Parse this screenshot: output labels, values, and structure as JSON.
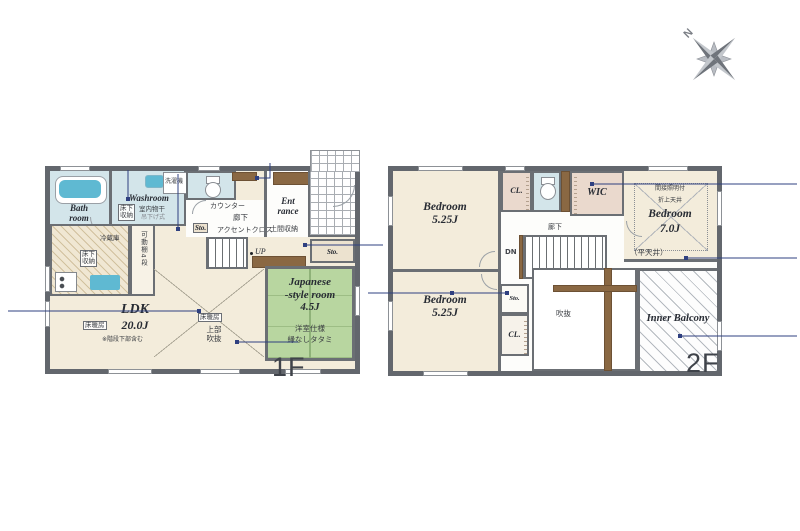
{
  "compass": {
    "north": "N"
  },
  "floor1": {
    "label": "1F",
    "bath": {
      "line1": "Bath",
      "line2": "room"
    },
    "washroom": {
      "name": "Washroom",
      "underfloor_l1": "床下",
      "underfloor_l2": "収納",
      "drying": "室内物干",
      "drying_sub": "吊下げ式",
      "laundry": "洗濯機"
    },
    "hall": {
      "counter": "カウンター",
      "corridor": "廊下",
      "storage": "Sto.",
      "accent_wall": "アクセントクロス",
      "up": "UP"
    },
    "entrance": {
      "line1": "Ent",
      "line2": "rance",
      "doma_storage": "土間収納",
      "storage": "Sto."
    },
    "kitchen": {
      "fridge": "冷蔵庫",
      "underfloor_l1": "床下",
      "underfloor_l2": "収納",
      "shelf": "可動棚4段"
    },
    "ldk": {
      "floor_heating": "床暖房",
      "name": "LDK",
      "size": "20.0J",
      "note": "※階段下部含む"
    },
    "void_above": {
      "floor_heating": "床暖房",
      "line1": "上部",
      "line2": "吹抜"
    },
    "japanese_room": {
      "line1": "Japanese",
      "line2": "-style room",
      "line3": "4.5J",
      "note1": "洋室仕様",
      "note2": "縁なしタタミ"
    }
  },
  "floor2": {
    "label": "2F",
    "bedroom_nw": {
      "name": "Bedroom",
      "size": "5.25J"
    },
    "closet_top": "CL.",
    "wic": "WIC",
    "bedroom_ne": {
      "note_lighting": "間接照明付",
      "note_ceiling": "折上天井",
      "name": "Bedroom",
      "size": "7.0J",
      "note_flat": "（平天井）"
    },
    "corridor": "廊下",
    "down": "DN",
    "bedroom_sw": {
      "name": "Bedroom",
      "size": "5.25J"
    },
    "storage": "Sto.",
    "closet_bottom": "CL.",
    "void": "吹抜",
    "balcony": "Inner Balcony"
  },
  "colors": {
    "wall": "#63676d",
    "wet_room": "#d3e5ea",
    "fixture_blue": "#5fb9d2",
    "tatami_green": "#b8d6a0",
    "floor_beige": "#f3ecdb",
    "closet_pink": "#ead9cd",
    "wood_brown": "#8a6843",
    "callout_navy": "#2f4080"
  }
}
